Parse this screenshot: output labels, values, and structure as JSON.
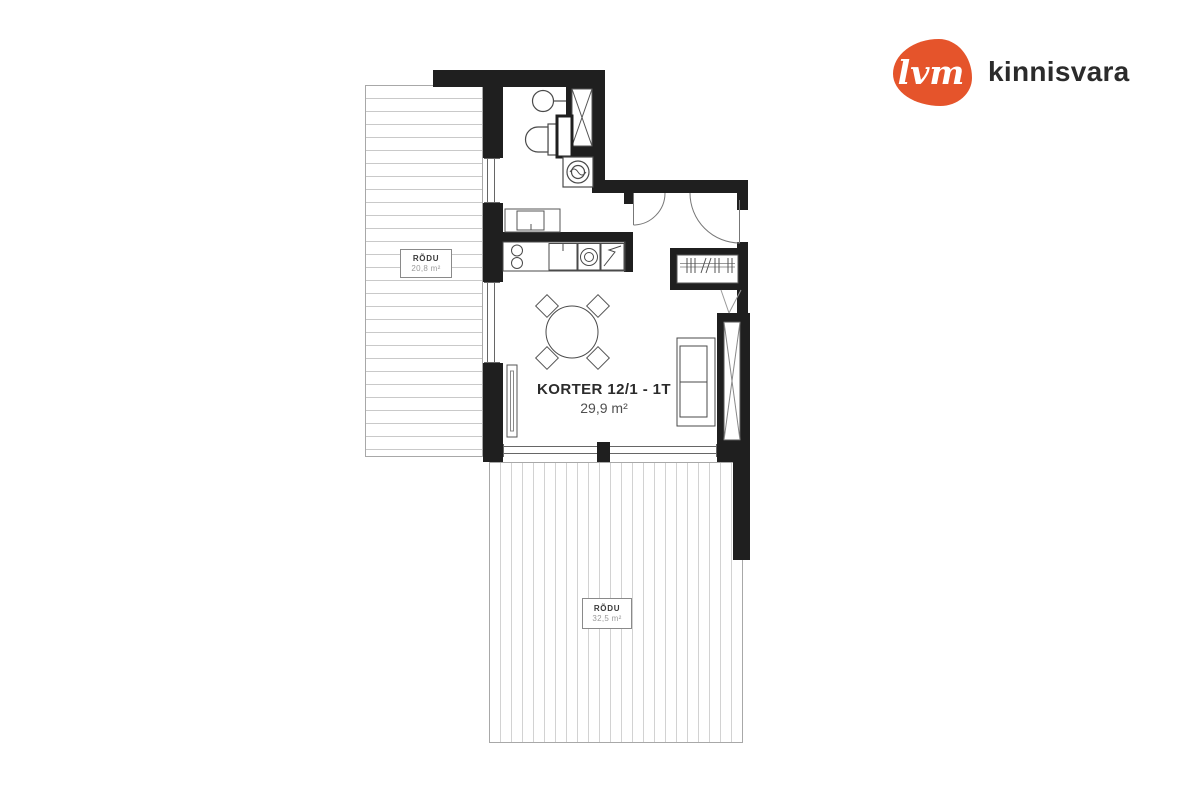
{
  "brand": {
    "logo_text": "lvm",
    "company": "kinnisvara"
  },
  "unit": {
    "title": "KORTER 12/1 - 1T",
    "area": "29,9 m²"
  },
  "balconies": {
    "left": {
      "label": "RÕDU",
      "area": "20,8 m²"
    },
    "bottom": {
      "label": "RÕDU",
      "area": "32,5 m²"
    }
  },
  "colors": {
    "wall": "#1f1f1f",
    "logo_orange": "#e5542b",
    "brand_text": "#2b2b2b",
    "terrace_stripe": "#cccccc",
    "label_muted": "#9a9a9a"
  }
}
